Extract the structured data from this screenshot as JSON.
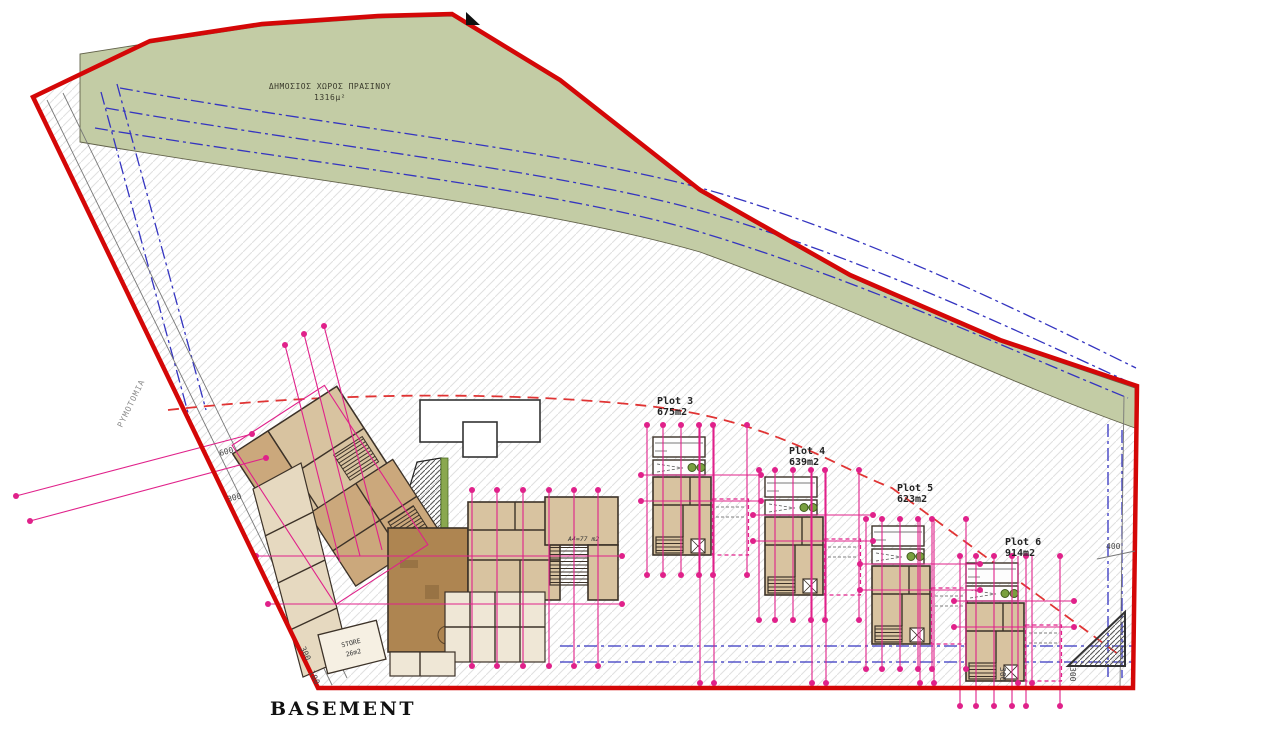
{
  "drawing": {
    "title": "BASEMENT",
    "green_area": {
      "label": "ΔΗΜΟΣΙΟΣ ΧΩΡΟΣ ΠΡΑΣΙΝΟΥ",
      "area": "1316μ²"
    },
    "boundary_label": "ΡΥΜΟΤΟΜΙΑ",
    "plots": [
      {
        "name": "Plot 3",
        "area": "675m2"
      },
      {
        "name": "Plot 4",
        "area": "639m2"
      },
      {
        "name": "Plot 5",
        "area": "623m2"
      },
      {
        "name": "Plot 6",
        "area": "914m2"
      }
    ],
    "rooms": {
      "store_label": "STORE",
      "store_area": "26m2",
      "apartment_label": "A4=77 m2"
    },
    "dimensions": {
      "right": "400",
      "left_upper": "600",
      "left_lower": "300",
      "bottom_left_a": "300",
      "bottom_left_b": "100",
      "plot6_a": "300",
      "plot6_b": "300"
    },
    "colors": {
      "boundary_red": "#d40707",
      "dimension_magenta": "#e0218a",
      "green_space": "#c3cca5",
      "utility_blue": "#3434c0",
      "setback_red": "#e03434",
      "room_tan": "#d8c3a0",
      "room_brown": "#ae8551"
    }
  }
}
